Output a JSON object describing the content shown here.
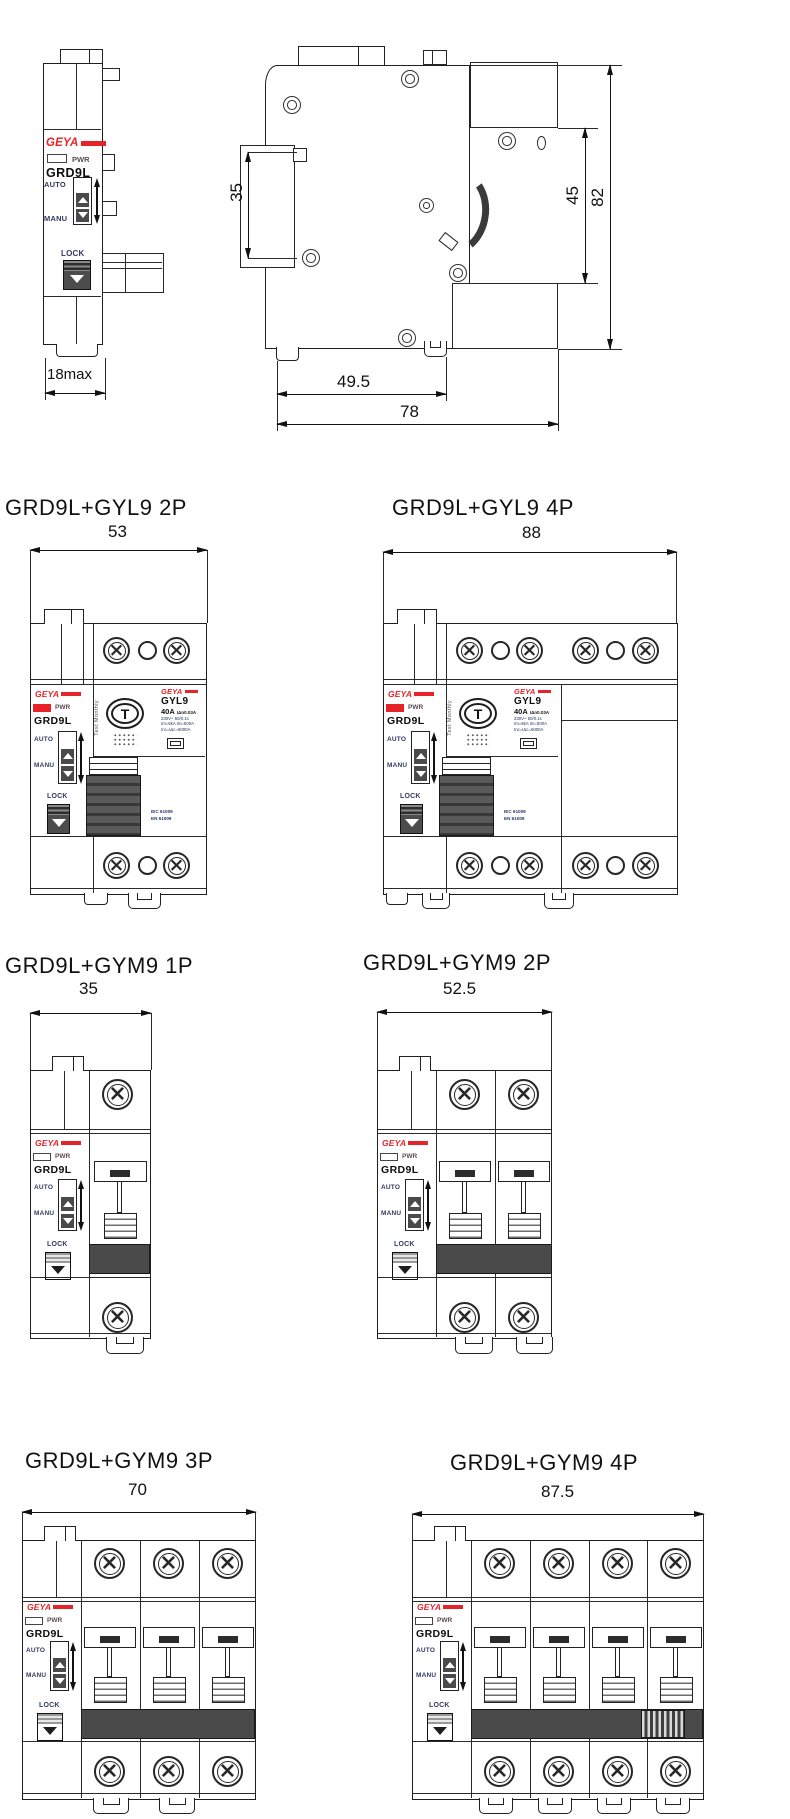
{
  "brand": {
    "name": "GEYA",
    "accent_color": "#e62329"
  },
  "colors": {
    "line": "#222222",
    "toggle_gray": "#4a4a4a"
  },
  "module": {
    "pwr": "PWR",
    "model": "GRD9L",
    "auto": "AUTO",
    "manu": "MANU",
    "lock": "LOCK"
  },
  "rcd": {
    "model": "GYL9",
    "rating": "40A",
    "rating_small": "IΔn0.03A",
    "spec_line1": "230V~ 50/0.1s",
    "spec_line2": "Im=6kA Im=500A",
    "spec_line3": "Inc=IΔc=6000A",
    "test_letter": "T",
    "test_note": "Test Monthly",
    "cert_line1": "IEC 61009",
    "cert_line2": "EN 61009"
  },
  "views": {
    "front": {
      "dim_width": "18max"
    },
    "side": {
      "dim_rail": "35",
      "dim_body": "45",
      "dim_height": "82",
      "dim_depth_inner": "49.5",
      "dim_depth": "78"
    },
    "gyl9_2p": {
      "title": "GRD9L+GYL9 2P",
      "dim_width": "53"
    },
    "gyl9_4p": {
      "title": "GRD9L+GYL9 4P",
      "dim_width": "88"
    },
    "gym9_1p": {
      "title": "GRD9L+GYM9 1P",
      "dim_width": "35"
    },
    "gym9_2p": {
      "title": "GRD9L+GYM9 2P",
      "dim_width": "52.5"
    },
    "gym9_3p": {
      "title": "GRD9L+GYM9 3P",
      "dim_width": "70"
    },
    "gym9_4p": {
      "title": "GRD9L+GYM9 4P",
      "dim_width": "87.5"
    }
  }
}
